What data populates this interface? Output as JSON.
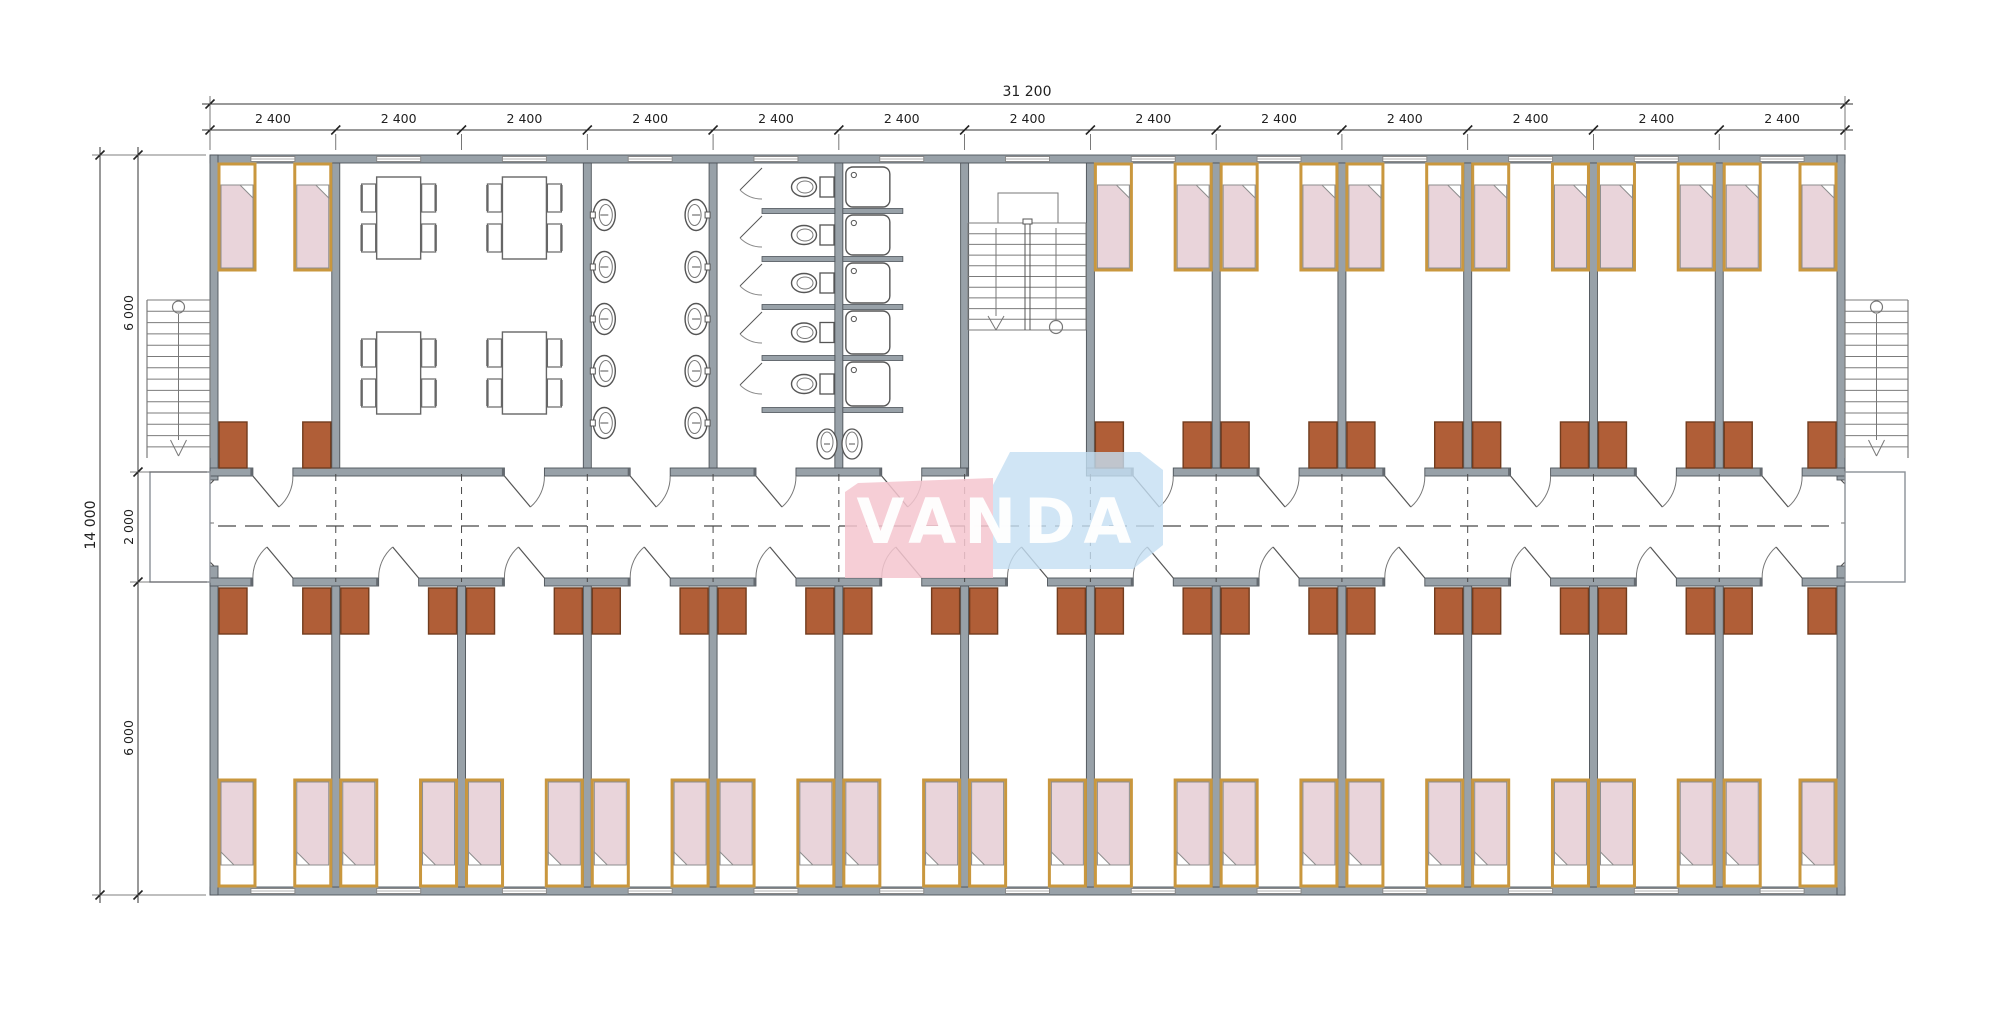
{
  "watermark": {
    "text": "VANDA"
  },
  "dimensions": {
    "top_total": "31 200",
    "module": "2 400",
    "module_count": 13,
    "side_total": "14 000",
    "side_segments": [
      "6 000",
      "2 000",
      "6 000"
    ]
  },
  "plan": {
    "top_rooms": [
      "bedroom",
      "canteen",
      "canteen",
      "washroom",
      "toilets",
      "showers",
      "stairwell",
      "bedroom",
      "bedroom",
      "bedroom",
      "bedroom",
      "bedroom",
      "bedroom"
    ],
    "bottom_rooms": [
      "bedroom",
      "bedroom",
      "bedroom",
      "bedroom",
      "bedroom",
      "bedroom",
      "bedroom",
      "bedroom",
      "bedroom",
      "bedroom",
      "bedroom",
      "bedroom",
      "bedroom"
    ],
    "furniture": {
      "beds_per_bedroom": 2,
      "cabinets_per_bedroom": 2,
      "canteen_tables": 4,
      "chairs_per_table": 4,
      "wash_basins_per_wall": 5,
      "toilet_stalls": 5,
      "urinals": 2,
      "shower_stalls": 5
    },
    "stairs": {
      "internal": 1,
      "external": 2
    }
  },
  "colors": {
    "wall_fill": "#98a1a8",
    "wall_edge": "#4e545a",
    "wall_cap": "#646a70",
    "bed_frame": "#c9973e",
    "bed_blanket": "#e9d4da",
    "bed_outline": "#8d8d8d",
    "cabinet_fill": "#b05e37",
    "cabinet_edge": "#713c1e",
    "furniture_line": "#555555",
    "stair_line": "#7b7b7b",
    "dash_line": "#474747",
    "dim_text": "#1f1f1f",
    "watermark_pink": "#f5c6cf",
    "watermark_blue": "#c4def2"
  }
}
